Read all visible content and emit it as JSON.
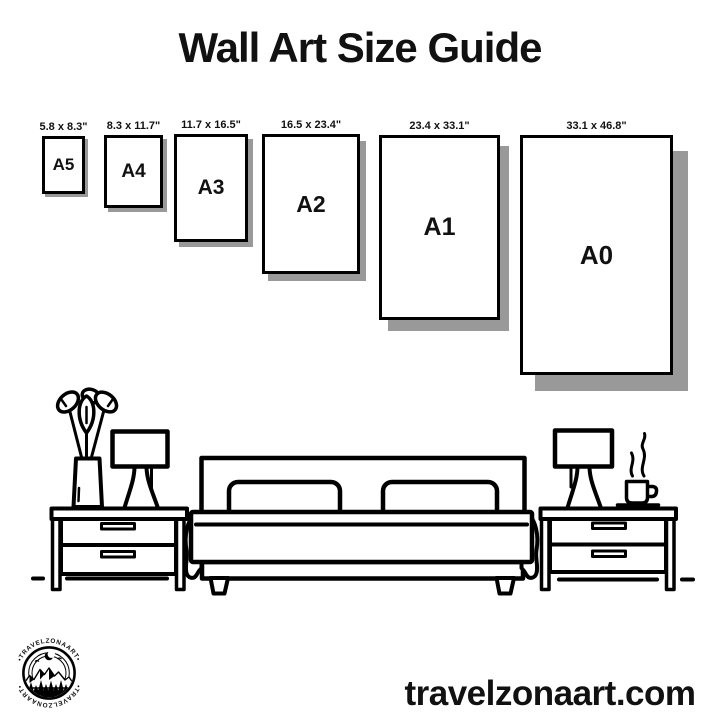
{
  "title": "Wall Art Size Guide",
  "sizes": [
    {
      "name": "A5",
      "dimensions": "5.8 x 8.3\""
    },
    {
      "name": "A4",
      "dimensions": "8.3 x 11.7\""
    },
    {
      "name": "A3",
      "dimensions": "11.7 x 16.5\""
    },
    {
      "name": "A2",
      "dimensions": "16.5 x 23.4\""
    },
    {
      "name": "A1",
      "dimensions": "23.4 x 33.1\""
    },
    {
      "name": "A0",
      "dimensions": "33.1 x 46.8\""
    }
  ],
  "logo": {
    "arc_text_top": "•TRAVELZONAART•",
    "arc_text_bottom": "•TRAVELZONAART•"
  },
  "footer": {
    "website": "travelzonaart.com"
  },
  "colors": {
    "ink": "#111111",
    "shadow": "#999999",
    "paper": "#ffffff"
  }
}
